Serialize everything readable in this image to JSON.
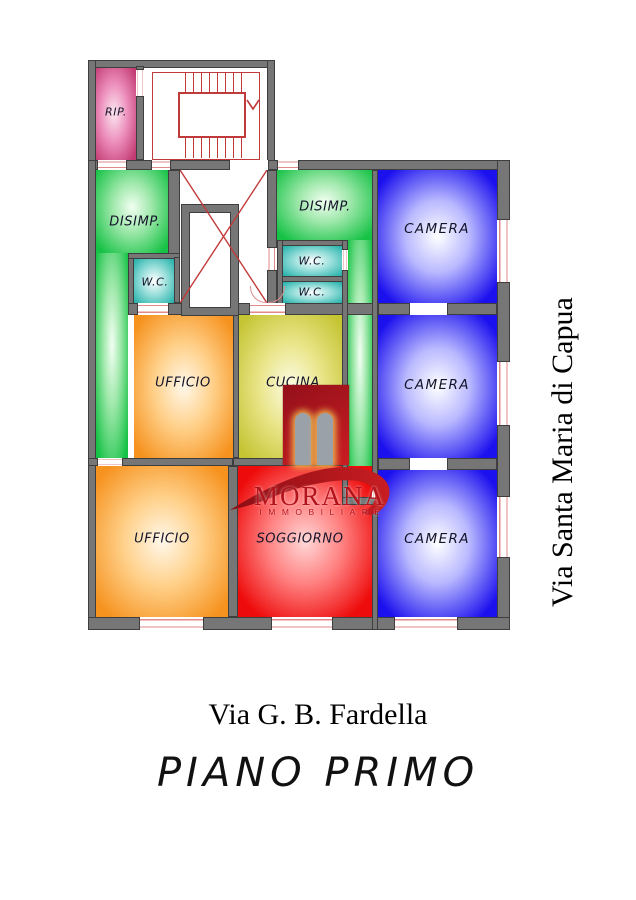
{
  "plan": {
    "rooms": {
      "rip": "RIP.",
      "disimp_left": "DISIMP.",
      "disimp_right": "DISIMP.",
      "wc_left": "W.C.",
      "wc_right_upper": "W.C.",
      "wc_right_lower": "W.C.",
      "ufficio_middle": "UFFICIO",
      "cucina": "CUCINA",
      "camera_top": "CAMERA",
      "camera_middle": "CAMERA",
      "camera_bottom": "CAMERA",
      "ufficio_bottom": "UFFICIO",
      "soggiorno": "SOGGIORNO"
    }
  },
  "watermark": {
    "brand": "MORANA",
    "subtitle": "IMMOBILIARE"
  },
  "captions": {
    "street_right": "Via Santa Maria di Capua",
    "street_bottom": "Via G. B. Fardella",
    "floor_title": "PIANO PRIMO"
  },
  "colors": {
    "wall": "#767676",
    "camera_blue": "#1b10ee",
    "disimp_green": "#16c246",
    "wc_teal": "#2ab3ac",
    "ufficio_orange": "#f6921e",
    "cucina_yellow": "#c5c433",
    "soggiorno_red": "#ee0b0b",
    "rip_magenta": "#c23a72",
    "plan_line_red": "#c13a3a",
    "door_line_red": "#e08a8a",
    "brand_red": "#b5131b",
    "label_text": "#14142a"
  }
}
